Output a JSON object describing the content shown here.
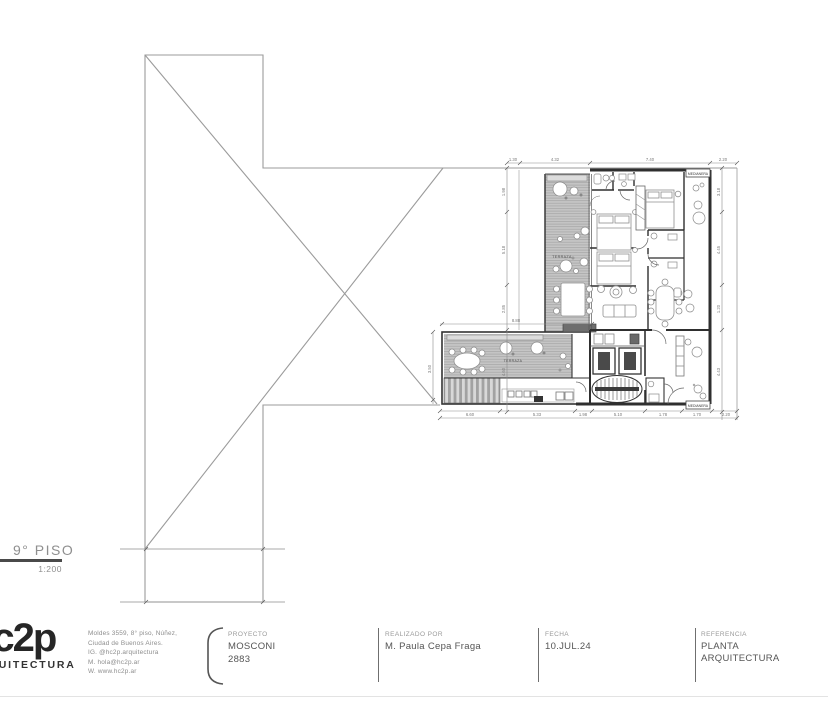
{
  "drawing": {
    "floor_label": "9° PISO",
    "scale_label": "1:200",
    "plan_labels": {
      "terrace": "TERRAZA",
      "terrace_wing": "TERRAZA",
      "party_wall": "MEDIANERA"
    },
    "dimensions": {
      "top": [
        "1.30",
        "4.32",
        "7.40",
        "2.20"
      ],
      "bottom": [
        "6.60",
        "5.33",
        "1.98",
        "5.10",
        "1.78",
        "1.70",
        "2.20"
      ],
      "left": [
        "1.98",
        "5.18",
        "2.85",
        "4.60"
      ],
      "right": [
        "3.18",
        "4.45",
        "1.20",
        "4.43"
      ],
      "wing_top": "8.88",
      "wing_left": "3.50"
    }
  },
  "titleblock": {
    "logo_line1": "hc2p",
    "logo_line2": "ARQUITECTURA",
    "address_lines": [
      "Moldes 3559, 8° piso, Núñez,",
      "Ciudad de Buenos Aires.",
      "IG. @hc2p.arquitectura",
      "M. hola@hc2p.ar",
      "W. www.hc2p.ar"
    ],
    "project_label": "PROYECTO",
    "project_name": "MOSCONI",
    "project_number": "2883",
    "author_label": "REALIZADO POR",
    "author_name": "M. Paula Cepa Fraga",
    "date_label": "FECHA",
    "date_value": "10.JUL.24",
    "reference_label": "REFERENCIA",
    "reference_line1": "PLANTA",
    "reference_line2": "ARQUITECTURA"
  }
}
